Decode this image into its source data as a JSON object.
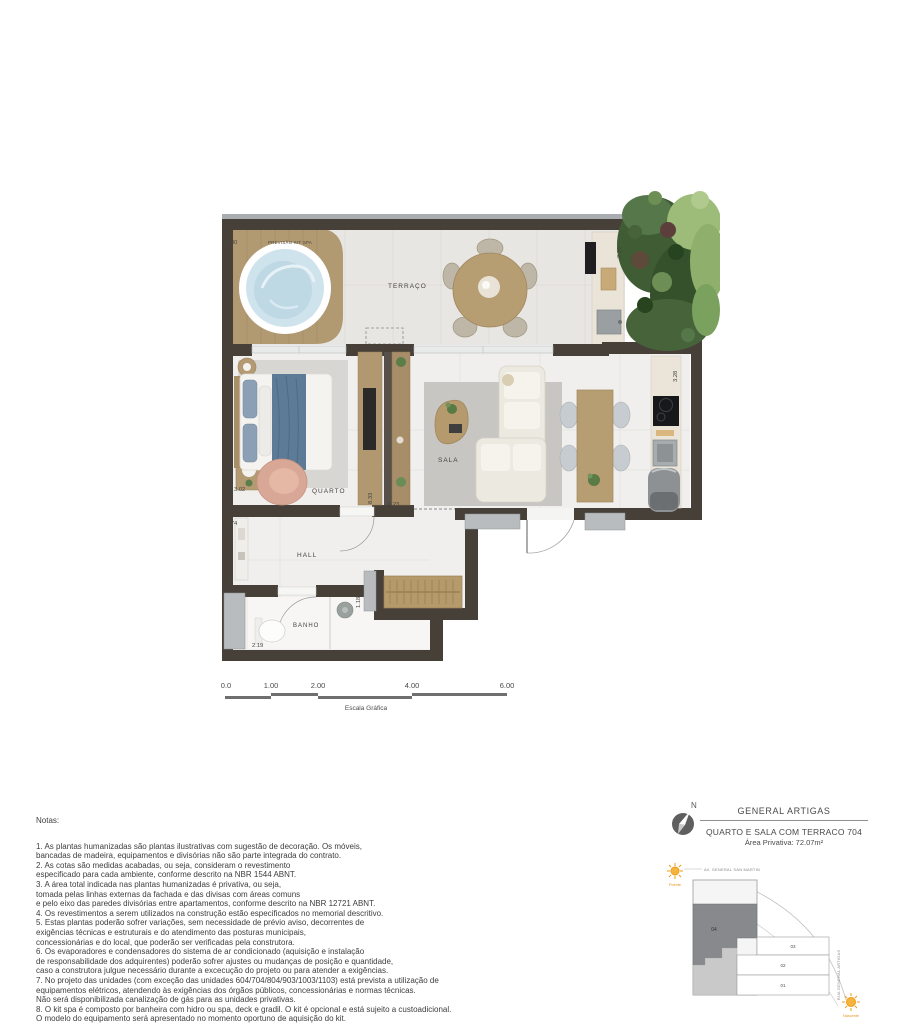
{
  "floor_plan": {
    "rooms": {
      "terraco": "TERRAÇO",
      "quarto": "QUARTO",
      "sala": "SALA",
      "hall": "HALL",
      "banho": "BANHO"
    },
    "annotations": {
      "kit_spa": "PREVISÃO KIT SPA"
    },
    "dimensions": {
      "terrace_width": "8.30",
      "terrace_right": "2.25",
      "kitchen_right": "3.28",
      "quarto_left": "3.02",
      "hall_top": "4.74",
      "hall_left": "1.46",
      "banho_bottom": "2.19",
      "partition_height": "8.33",
      "sala_width": "6.23",
      "closet_side": "1.18"
    }
  },
  "scale_bar": {
    "ticks": [
      "0.0",
      "1.00",
      "2.00",
      "4.00",
      "6.00"
    ],
    "label": "Escala Gráfica"
  },
  "title_block": {
    "north_label": "N",
    "project": "GENERAL ARTIGAS",
    "unit": "QUARTO E SALA COM TERRACO 704",
    "area": "Área Privativa: 72.07m²"
  },
  "site_map": {
    "street_top": "AV. GENERAL SAN MARTIN",
    "street_right": "RUA GENERAL ARTIGAS",
    "sun_west": "Poente",
    "sun_east": "Nascente",
    "units": {
      "u04": "04",
      "u03": "03",
      "u02": "02",
      "u01": "01"
    }
  },
  "notes": {
    "title": "Notas:",
    "items": [
      "1. As plantas humanizadas são plantas ilustrativas com sugestão de decoração. Os móveis,",
      "bancadas de madeira, equipamentos e divisórias não são parte integrada do contrato.",
      "2. As cotas são medidas acabadas, ou seja, consideram o revestimento",
      "especificado para cada ambiente, conforme descrito na NBR 1544 ABNT.",
      "3. A área total indicada nas plantas humanizadas é privativa, ou seja,",
      "tomada pelas linhas externas da fachada e das divisas com áreas comuns",
      "e pelo eixo das paredes divisórias entre apartamentos, conforme descrito na NBR 12721 ABNT.",
      "4. Os revestimentos a serem utilizados na construção estão especificados no memorial descritivo.",
      "5. Estas plantas poderão sofrer variações, sem necessidade de prévio aviso, decorrentes de",
      "exigências técnicas e estruturais e do atendimento das posturas municipais,",
      "concessionárias e do local, que poderão ser verificadas pela construtora.",
      "6. Os evaporadores e condensadores do sistema de ar condicionado (aquisição e instalação",
      "de responsabilidade dos adquirentes) poderão sofrer ajustes ou mudanças de posição e quantidade,",
      "caso a construtora julgue necessário durante a excecução do projeto ou para atender a exigências.",
      "7. No projeto das unidades (com exceção das unidades 604/704/804/903/1003/1103) está prevista a utilização de",
      "equipamentos elétricos, atendendo às exigências dos órgãos públicos, concessionárias e normas técnicas.",
      "Não será disponibilizada canalização de gás para as unidades privativas.",
      "8. O kit spa é composto por banheira com hidro ou spa, deck e gradil. O kit é opcional e está sujeito a custoadicional.",
      "O modelo do equipamento será apresentado no momento oportuno de aquisição do kit."
    ]
  },
  "colors": {
    "wall": "#474039",
    "wood": "#b29871",
    "spa_water": "#cfe3ec",
    "sun_orange": "#ef9a1a",
    "unit_highlight": "#87898c"
  }
}
